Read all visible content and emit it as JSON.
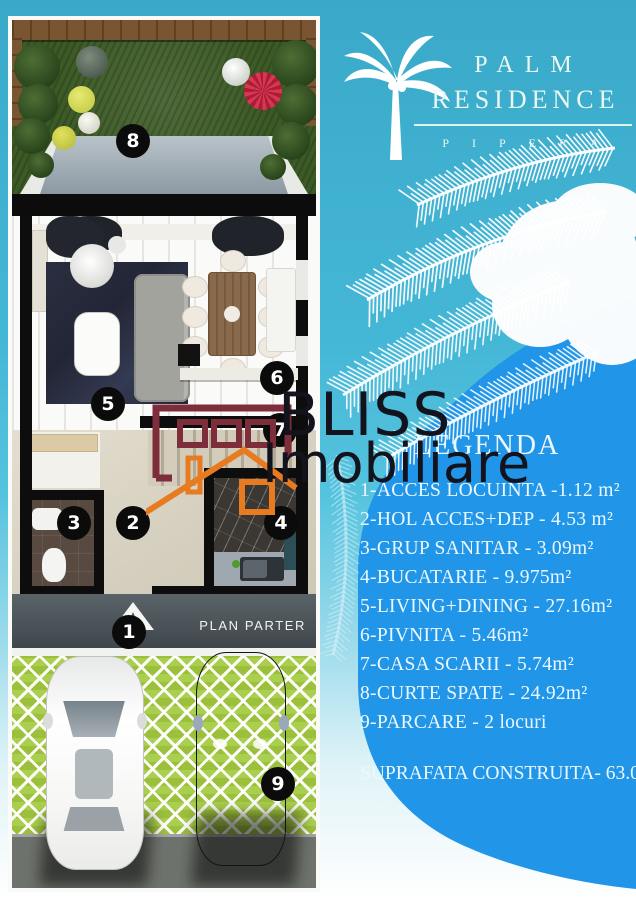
{
  "brand": {
    "palm": "PALM",
    "residence": "RESIDENCE",
    "location": "PIPERA"
  },
  "legend": {
    "title": "LEGENDA",
    "items": [
      "1-ACCES LOCUINTA -1.12 m²",
      "2-HOL ACCES+DEP - 4.53 m²",
      "3-GRUP SANITAR - 3.09m²",
      "4-BUCATARIE - 9.975m²",
      "5-LIVING+DINING - 27.16m²",
      "6-PIVNITA - 5.46m²",
      "7-CASA SCARII - 5.74m²",
      "8-CURTE SPATE - 24.92m²",
      "9-PARCARE - 2 locuri"
    ],
    "total": "SUPRAFATA CONSTRUITA- 63.059m²"
  },
  "plan": {
    "label": "PLAN PARTER",
    "badge_numbers": [
      "1",
      "2",
      "3",
      "4",
      "5",
      "6",
      "7",
      "8",
      "9"
    ]
  },
  "watermark": {
    "line1": "BLISS",
    "line2": "Imobiliare"
  },
  "colors": {
    "teal": "#45b7d6",
    "royal_blue": "#2196e8",
    "watermark_maroon": "#7e2e3b",
    "watermark_orange": "#e87b20",
    "badge_black": "#0b0b0b",
    "grass_green": "#3c5a25"
  }
}
